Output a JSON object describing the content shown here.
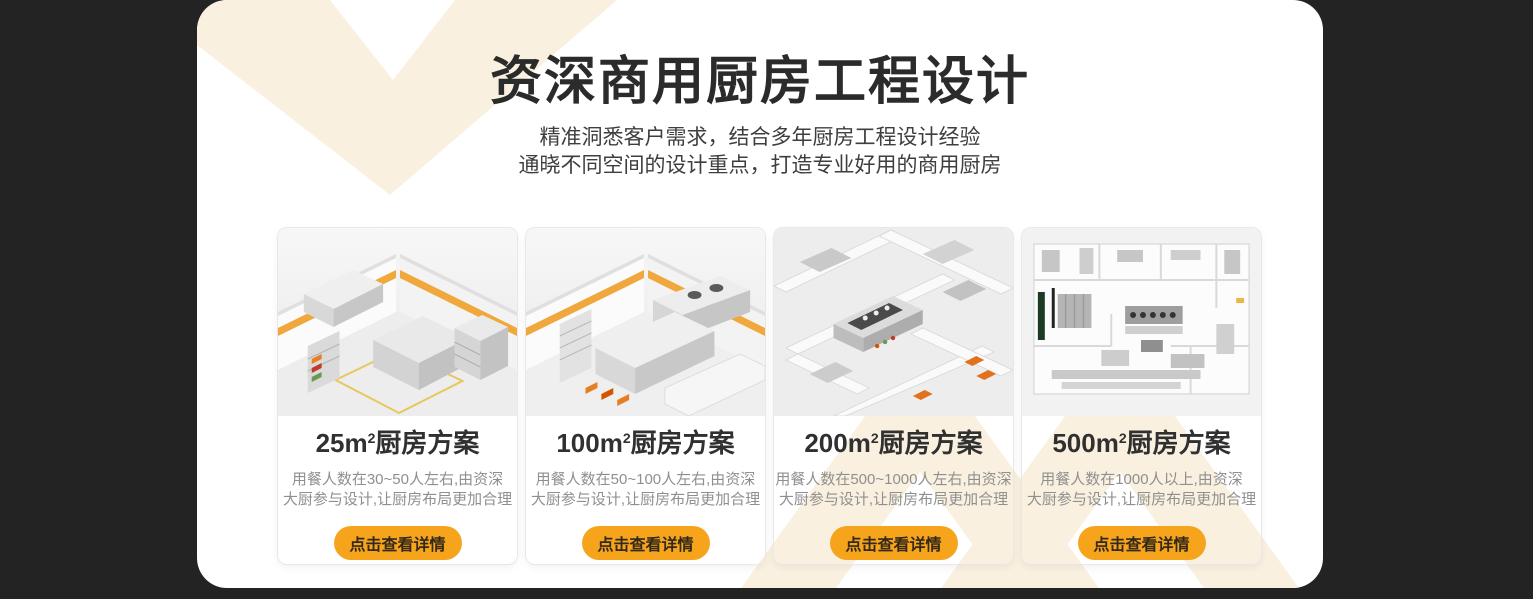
{
  "page": {
    "background_color": "#232323",
    "panel_color": "#FFFFFF",
    "accent_color": "#F7A41D",
    "decor_color": "#FAF0E0"
  },
  "header": {
    "title": "资深商用厨房工程设计",
    "subtitle_line1": "精准洞悉客户需求，结合多年厨房工程设计经验",
    "subtitle_line2": "通晓不同空间的设计重点，打造专业好用的商用厨房"
  },
  "cards": [
    {
      "title_prefix": "25m",
      "title_sup": "2",
      "title_suffix": "厨房方案",
      "desc_line1": "用餐人数在30~50人左右,由资深",
      "desc_line2": "大厨参与设计,让厨房布局更加合理",
      "button_label": "点击查看详情",
      "image": "isometric-kitchen-render-25"
    },
    {
      "title_prefix": "100m",
      "title_sup": "2",
      "title_suffix": "厨房方案",
      "desc_line1": "用餐人数在50~100人左右,由资深",
      "desc_line2": "大厨参与设计,让厨房布局更加合理",
      "button_label": "点击查看详情",
      "image": "isometric-kitchen-render-100"
    },
    {
      "title_prefix": "200m",
      "title_sup": "2",
      "title_suffix": "厨房方案",
      "desc_line1": "用餐人数在500~1000人左右,由资深",
      "desc_line2": "大厨参与设计,让厨房布局更加合理",
      "button_label": "点击查看详情",
      "image": "isometric-kitchen-render-200"
    },
    {
      "title_prefix": "500m",
      "title_sup": "2",
      "title_suffix": "厨房方案",
      "desc_line1": "用餐人数在1000人以上,由资深",
      "desc_line2": "大厨参与设计,让厨房布局更加合理",
      "button_label": "点击查看详情",
      "image": "kitchen-floorplan-render-500"
    }
  ]
}
